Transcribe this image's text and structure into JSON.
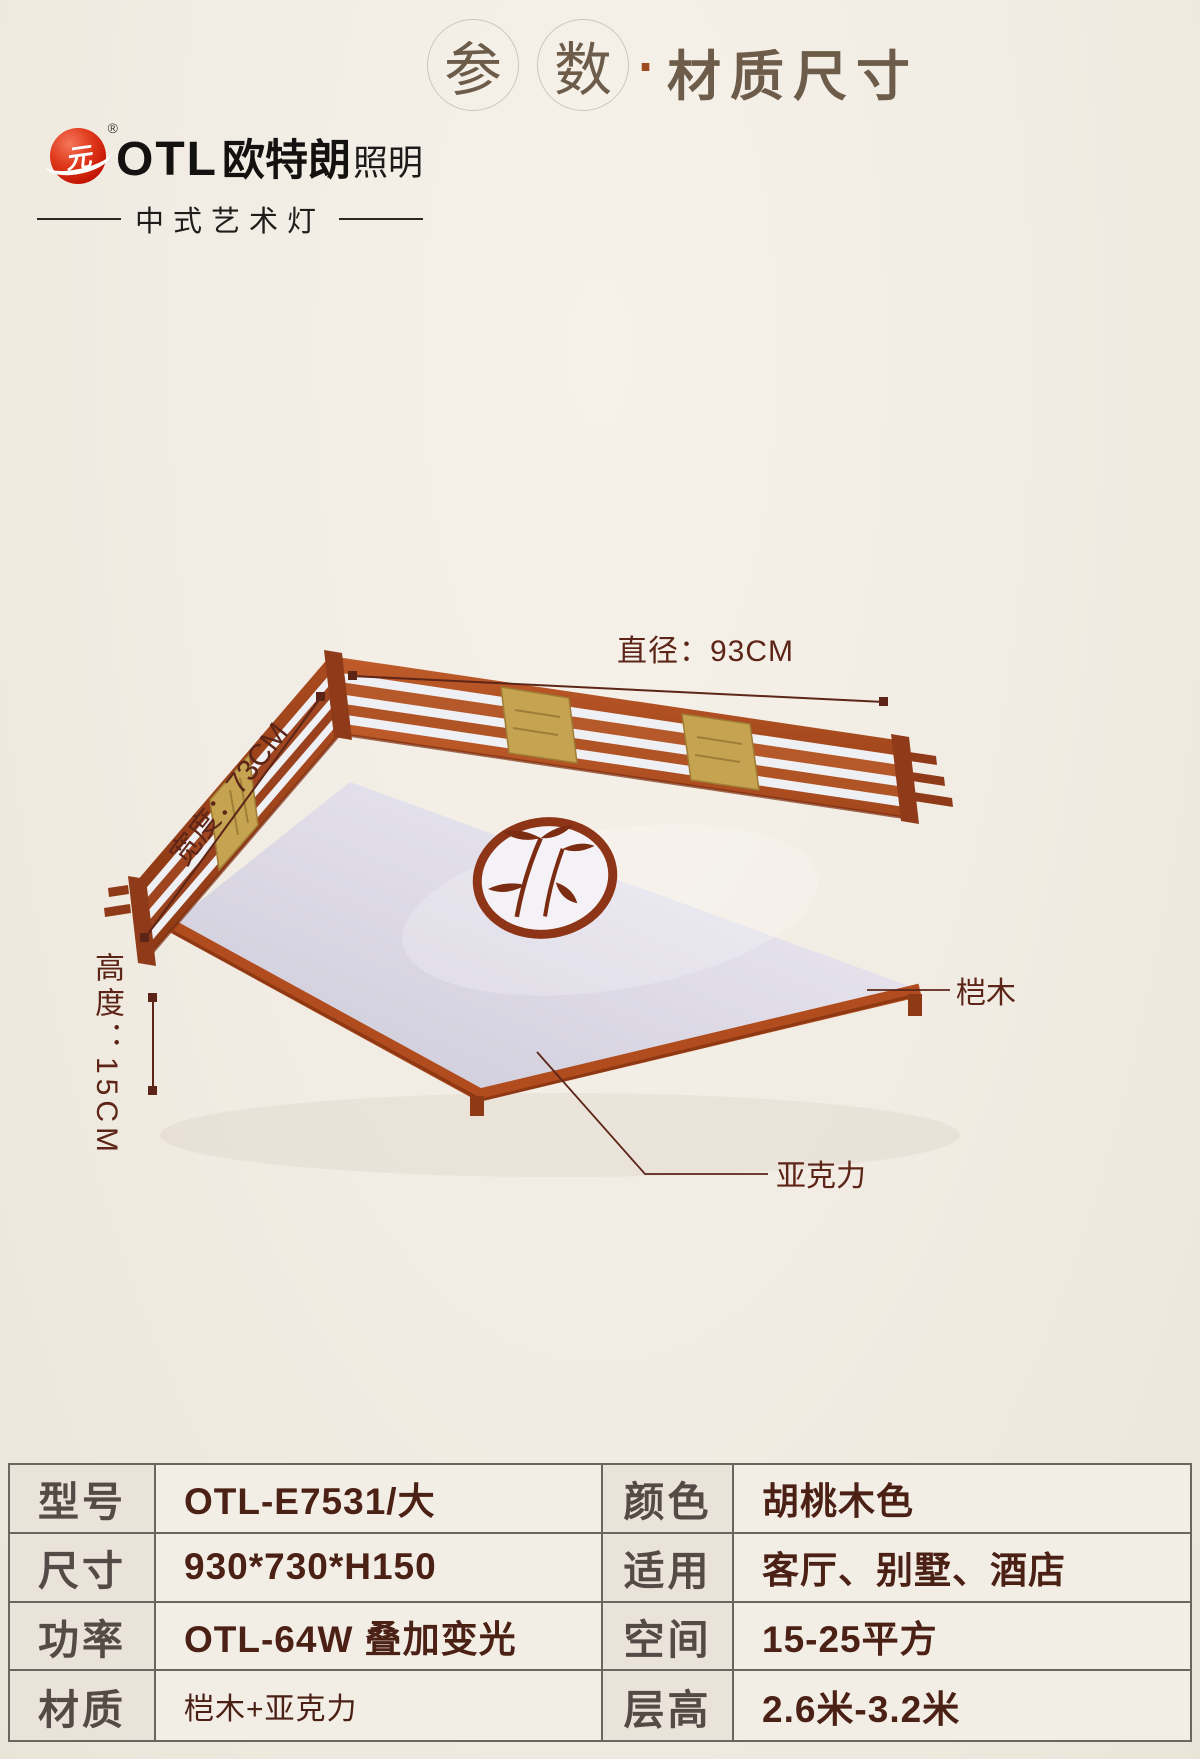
{
  "header": {
    "circle_chars": [
      "参",
      "数"
    ],
    "separator": "·",
    "subtitle": "材质尺寸"
  },
  "logo": {
    "mark": "元",
    "registered": "®",
    "brand_en": "OTL",
    "brand_cn": "欧特朗",
    "brand_tail": "照明",
    "tagline": "中式艺术灯"
  },
  "diagram": {
    "diameter_label": "直径：93CM",
    "width_label": "宽度：73CM",
    "height_label": "高度：15CM",
    "wood_label": "桤木",
    "acrylic_label": "亚克力"
  },
  "spec_table": {
    "rows": [
      {
        "label_left": "型号",
        "value_left": "OTL-E7531/大",
        "label_right": "颜色",
        "value_right": "胡桃木色"
      },
      {
        "label_left": "尺寸",
        "value_left": "930*730*H150",
        "label_right": "适用",
        "value_right": "客厅、别墅、酒店"
      },
      {
        "label_left": "功率",
        "value_left": "OTL-64W 叠加变光",
        "label_right": "空间",
        "value_right": "15-25平方"
      },
      {
        "label_left": "材质",
        "value_left": "桤木+亚克力",
        "label_right": "层高",
        "value_right": "2.6米-3.2米"
      }
    ]
  },
  "colors": {
    "background": "#f1ece3",
    "wood": "#a8491f",
    "wood_dark": "#7c2e10",
    "brass": "#c6a351",
    "acrylic": "#e6e4ee",
    "dimension_text": "#5c2517",
    "table_border": "#6b6560",
    "header_text": "#6d5c4a",
    "logo_red": "#d31f0f"
  }
}
